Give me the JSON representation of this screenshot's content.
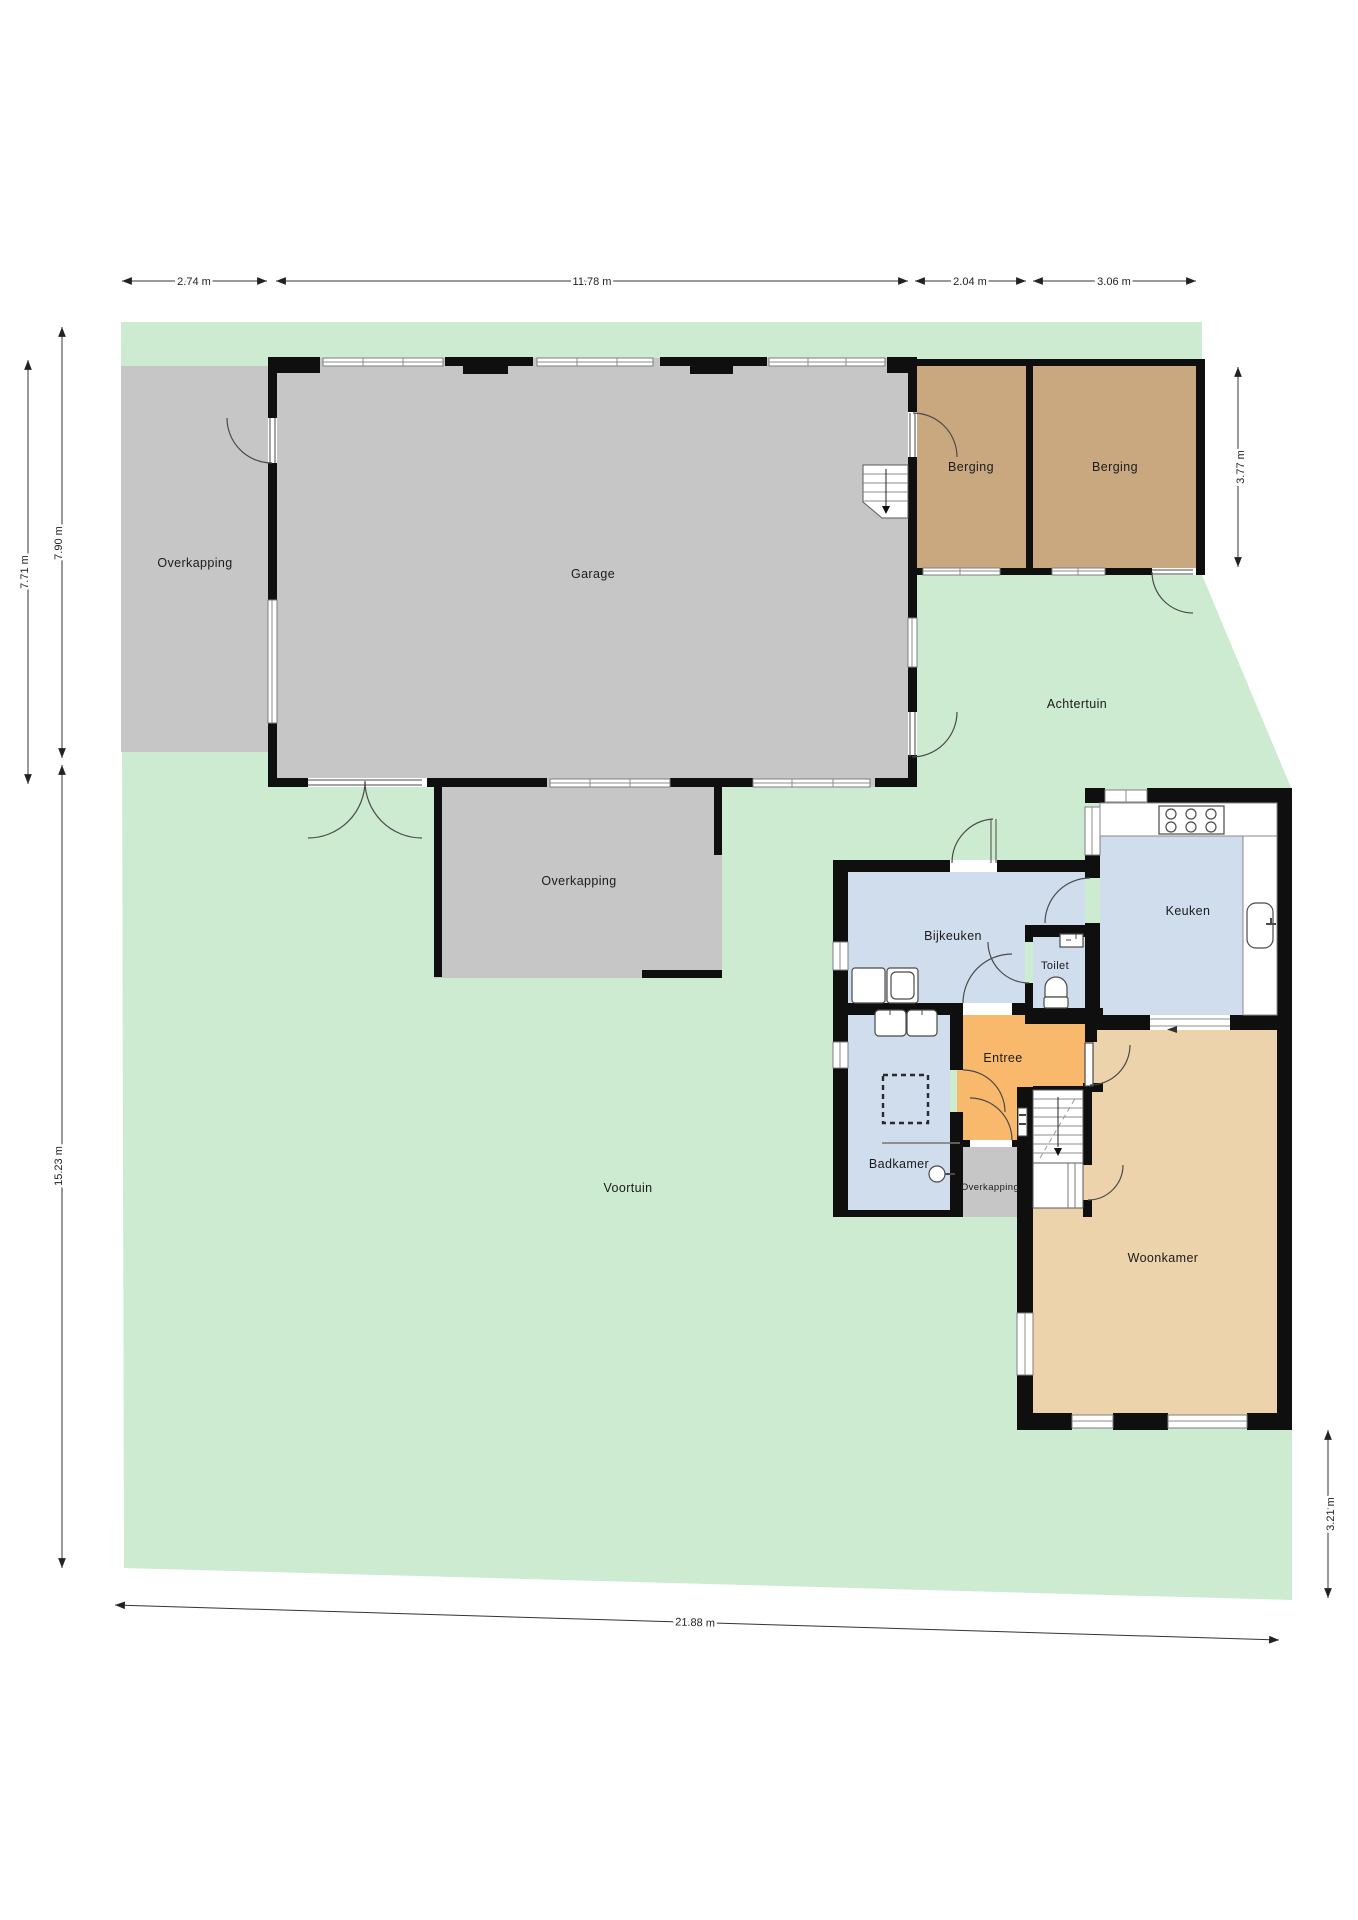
{
  "rooms": [
    {
      "id": "overkapping-left",
      "label": "Overkapping"
    },
    {
      "id": "garage",
      "label": "Garage"
    },
    {
      "id": "berging-1",
      "label": "Berging"
    },
    {
      "id": "berging-2",
      "label": "Berging"
    },
    {
      "id": "achtertuin",
      "label": "Achtertuin"
    },
    {
      "id": "overkapping-annex",
      "label": "Overkapping"
    },
    {
      "id": "bijkeuken",
      "label": "Bijkeuken"
    },
    {
      "id": "toilet",
      "label": "Toilet"
    },
    {
      "id": "keuken",
      "label": "Keuken"
    },
    {
      "id": "entree",
      "label": "Entree"
    },
    {
      "id": "badkamer",
      "label": "Badkamer"
    },
    {
      "id": "overkapping-porch",
      "label": "Overkapping"
    },
    {
      "id": "voortuin",
      "label": "Voortuin"
    },
    {
      "id": "woonkamer",
      "label": "Woonkamer"
    }
  ],
  "dimensions": [
    {
      "id": "top-1",
      "label": "2.74 m"
    },
    {
      "id": "top-2",
      "label": "11.78 m"
    },
    {
      "id": "top-3",
      "label": "2.04 m"
    },
    {
      "id": "top-4",
      "label": "3.06 m"
    },
    {
      "id": "left-1",
      "label": "7.90 m"
    },
    {
      "id": "left-2",
      "label": "7.71 m"
    },
    {
      "id": "left-3",
      "label": "15.23 m"
    },
    {
      "id": "right-1",
      "label": "3.77 m"
    },
    {
      "id": "right-2",
      "label": "3.21 m"
    },
    {
      "id": "bottom-1",
      "label": "21.88 m"
    }
  ],
  "palette": {
    "garden_green": "#cdebd1",
    "hardscape_gray": "#c6c6c6",
    "storage_brown": "#c9a880",
    "wet_room_blue": "#cfddec",
    "hall_orange": "#f8b96d",
    "living_tan": "#ecd3ab",
    "wall_black": "#0f0f0f",
    "background": "#ffffff"
  }
}
